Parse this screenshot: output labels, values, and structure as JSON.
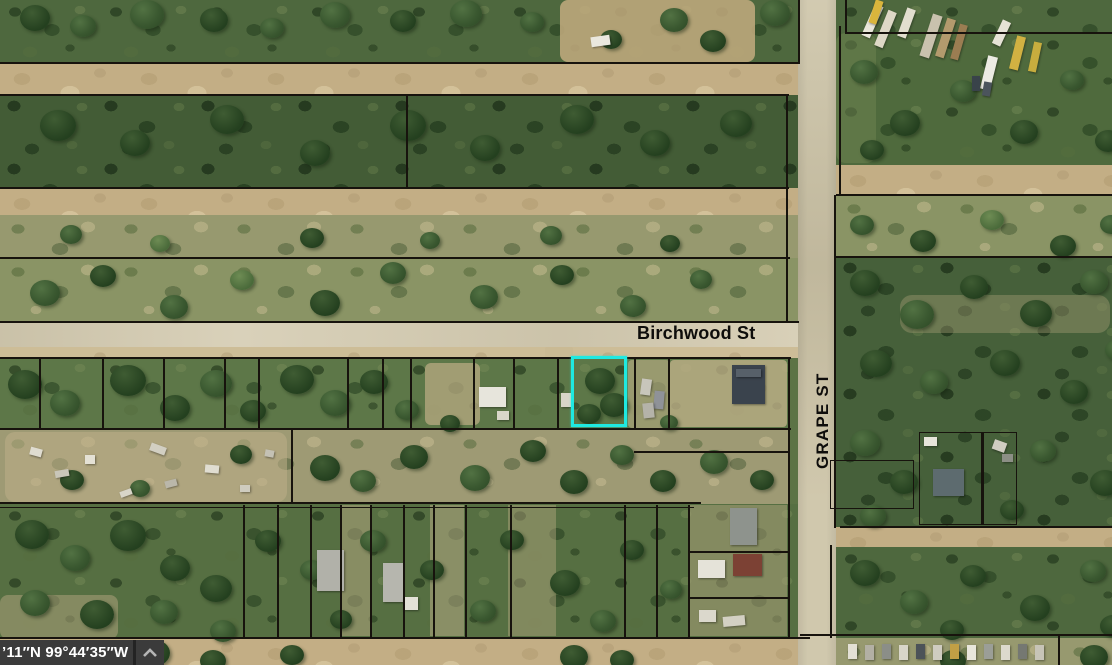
{
  "map": {
    "street_labels": {
      "horizontal": "Birchwood St",
      "vertical": "GRAPE ST"
    },
    "highlight": {
      "description": "selected-parcel-outline",
      "color": "#1fe9e1"
    },
    "colors": {
      "parcel_line": "#17130d",
      "paved_road": "#d5ccb2",
      "dirt_road": "#c3ae85",
      "vegetation": "#4e683e"
    }
  },
  "status_bar": {
    "coordinates_text": "’11″N 99°44′35″W",
    "collapse_icon": "chevron-up",
    "background": "#3b3b3b",
    "text_color": "#ffffff"
  }
}
